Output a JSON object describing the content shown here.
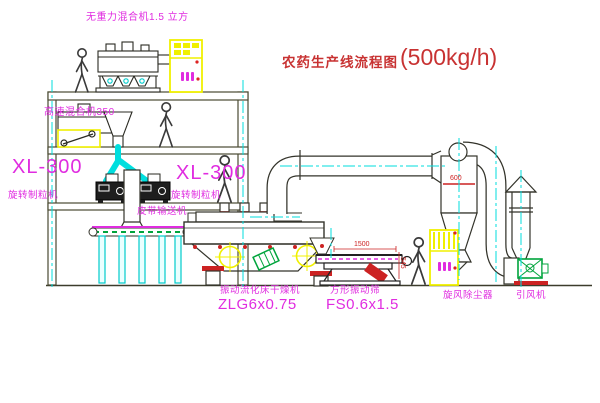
{
  "title": {
    "name": "农药生产线流程图",
    "capacity": "(500kg/h)"
  },
  "equipment_labels": {
    "gravity_free_mixer": "无重力混合机1.5 立方",
    "high_speed_mixer": "高速混合机350",
    "granulator_left_model": "XL-300",
    "granulator_left_name": "旋转制粒机",
    "granulator_mid_model": "XL-300",
    "granulator_mid_name": "旋转制粒机",
    "belt_conveyor": "皮带输送机",
    "fluid_bed_dryer_name": "振动流化床干燥机",
    "fluid_bed_dryer_model": "ZLG6x0.75",
    "square_sieve_name": "方形振动筛",
    "square_sieve_model": "FS0.6x1.5",
    "cyclone_dust_collector": "旋风除尘器",
    "induced_draft_fan": "引风机"
  },
  "dimension_annotations": {
    "cyclone_inlet": "600",
    "sieve_length": "1500",
    "sieve_height": "545"
  },
  "colors": {
    "label_magenta": "#e02ce0",
    "title_red": "#c83232",
    "highlight_yellow": "#f0f000",
    "centerline_cyan": "#00dede",
    "line_dark": "#3c3c2c",
    "accent_green": "#00a43c",
    "dimension_red": "#cc2222"
  }
}
